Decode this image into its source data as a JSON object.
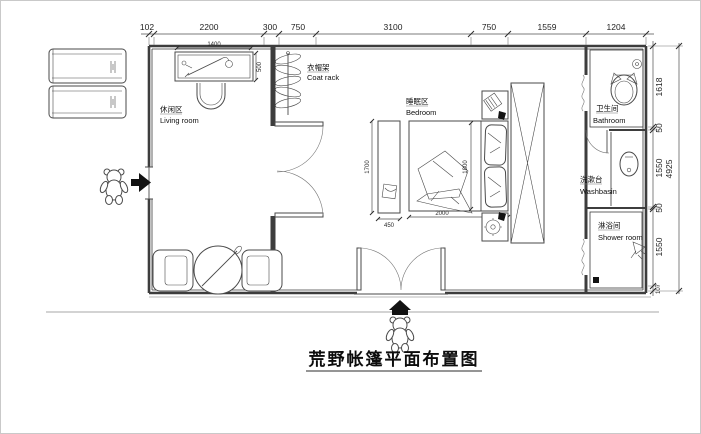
{
  "title": "荒野帐篷平面布置图",
  "rooms": {
    "living": {
      "zh": "休闲区",
      "en": "Living room"
    },
    "coat": {
      "zh": "衣帽架",
      "en": "Coat rack"
    },
    "bedroom": {
      "zh": "睡眠区",
      "en": "Bedroom"
    },
    "bathroom": {
      "zh": "卫生间",
      "en": "Bathroom"
    },
    "washbasin": {
      "zh": "洗漱台",
      "en": "Washbasin"
    },
    "shower": {
      "zh": "淋浴间",
      "en": "Shower room"
    }
  },
  "dims": {
    "top": [
      "102",
      "2200",
      "300",
      "750",
      "3100",
      "750",
      "1559",
      "1204"
    ],
    "right": [
      "1618",
      "50",
      "1550",
      "50",
      "1550",
      "107"
    ],
    "right_total": "4925",
    "desk_w": "1400",
    "desk_d": "500",
    "bench_l": "1700",
    "bench_w": "450",
    "bed_l": "2000",
    "bed_w": "1800"
  },
  "colors": {
    "line": "#3d3d3d",
    "dim_text": "#1f1f1f",
    "accent_black": "#111111"
  }
}
